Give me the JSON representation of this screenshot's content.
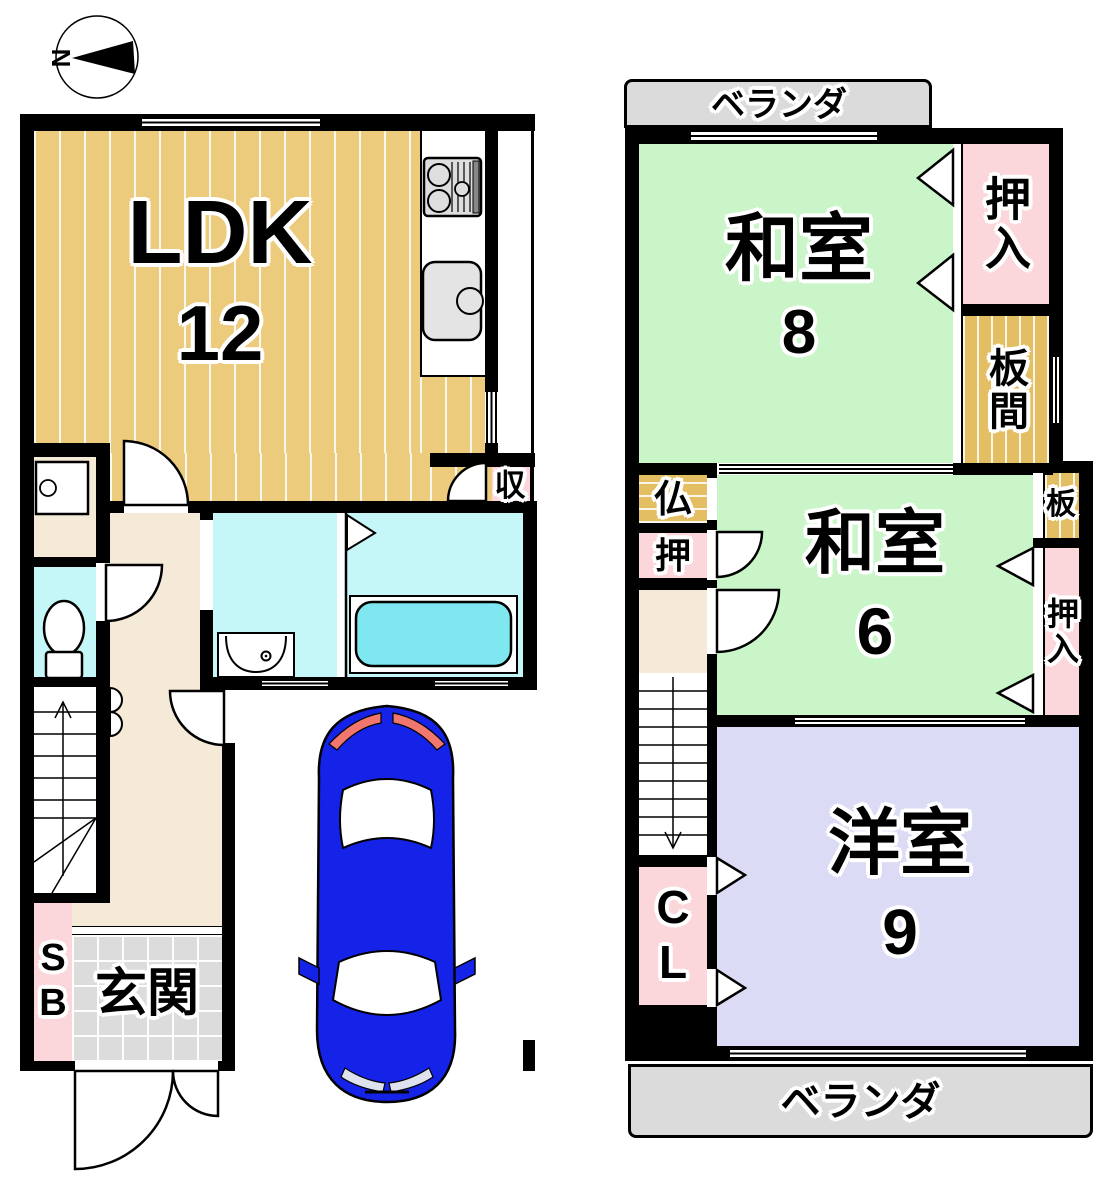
{
  "compass": {
    "north": "N"
  },
  "floor1": {
    "ldk": {
      "label": "LDK",
      "size": "12"
    },
    "storage": {
      "label": "収"
    },
    "shoebox": {
      "label": "SB"
    },
    "entrance": {
      "label": "玄関"
    }
  },
  "floor2": {
    "veranda_top": {
      "label": "ベランダ"
    },
    "washitsu8": {
      "label": "和室",
      "size": "8"
    },
    "oshiire_upper": {
      "label": "押入"
    },
    "itanoma": {
      "label": "板間"
    },
    "butsudan": {
      "label": "仏"
    },
    "oshi": {
      "label": "押"
    },
    "washitsu6": {
      "label": "和室",
      "size": "6"
    },
    "ita": {
      "label": "板"
    },
    "oshiire_middle": {
      "label": "押入"
    },
    "closet": {
      "label": "CL"
    },
    "youshitsu9": {
      "label": "洋室",
      "size": "9"
    },
    "veranda_bottom": {
      "label": "ベランダ"
    }
  },
  "icons": {
    "compass": "north-arrow-icon",
    "stove": "gas-stove-icon",
    "sink": "kitchen-sink-icon",
    "toilet": "toilet-icon",
    "vanity": "washbasin-icon",
    "bathtub": "bathtub-icon",
    "washer_pan": "washer-pan-icon",
    "car": "car-top-view-icon",
    "stairs_up": "stairs-up-arrow-icon",
    "stairs_down": "stairs-down-arrow-icon"
  },
  "palette": {
    "wall": "#000000",
    "wood_floor": "#ECCB7D",
    "tatami_green": "#C9F5C9",
    "western_lavender": "#DBDBF5",
    "closet_pink": "#FBD7DB",
    "wet_area_cyan": "#C5F6F8",
    "bathtub_cyan": "#7EE7F0",
    "hall_beige": "#F4EAD7",
    "veranda_gray": "#DBDBDB",
    "car_blue": "#1523E8",
    "tail_light_red": "#F0766E"
  }
}
